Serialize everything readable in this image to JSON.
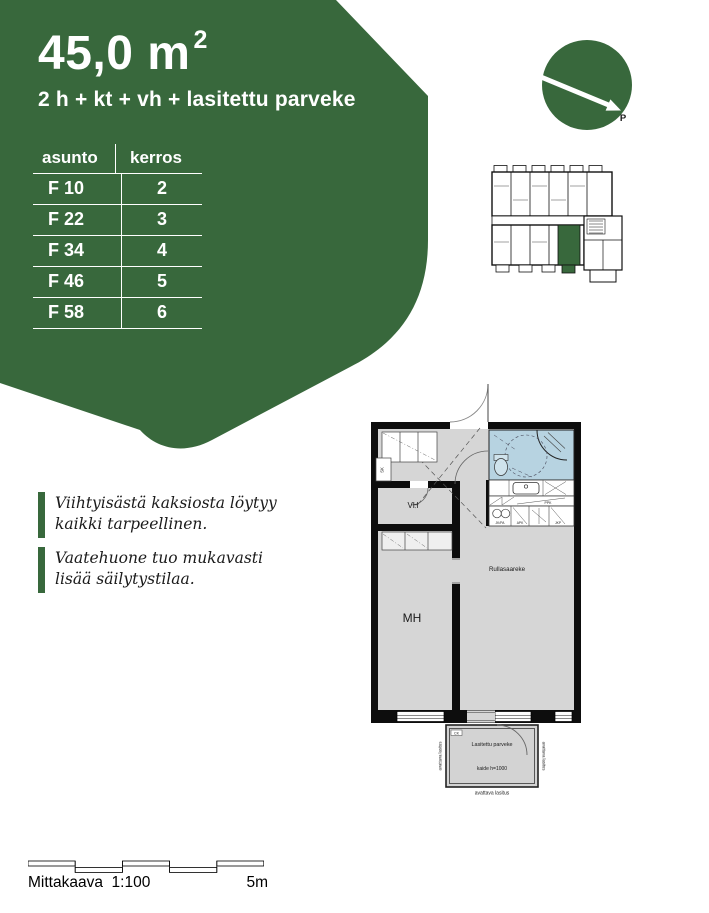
{
  "header": {
    "area_value": "45,0 m",
    "area_exponent": "2",
    "room_layout": "2 h + kt + vh + lasitettu parveke"
  },
  "apartment_table": {
    "col_apartment": "asunto",
    "col_floor": "kerros",
    "rows": [
      {
        "apartment": "F 10",
        "floor": "2"
      },
      {
        "apartment": "F 22",
        "floor": "3"
      },
      {
        "apartment": "F 34",
        "floor": "4"
      },
      {
        "apartment": "F 46",
        "floor": "5"
      },
      {
        "apartment": "F 58",
        "floor": "6"
      }
    ]
  },
  "compass": {
    "north_label": "P"
  },
  "floor_plan": {
    "labels": {
      "cleaning_closet": "SK",
      "walk_in_closet": "VH",
      "bedroom": "MH",
      "kitchen_island": "Rullasaareke",
      "laundry": "PPK",
      "appliance_left": "JK/PA",
      "appliance_mid": "APK",
      "appliance_right": "JKP",
      "balcony": "Lasitettu parveke",
      "railing": "kaide h=1000",
      "glazing": "avattava lasitus",
      "balcony_mark": "CK"
    }
  },
  "notes": [
    {
      "text": "Viihtyisästä kaksiosta löytyy kaikki tarpeellinen."
    },
    {
      "text": "Vaatehuone tuo mukavasti lisää säilytystilaa."
    }
  ],
  "scale_bar": {
    "label": "Mittakaava  1:100",
    "max_label": "5m"
  },
  "colors": {
    "brand_green": "#38683C",
    "bathroom_blue": "#B7D3E1",
    "floor_gray": "#D6D6D6"
  }
}
